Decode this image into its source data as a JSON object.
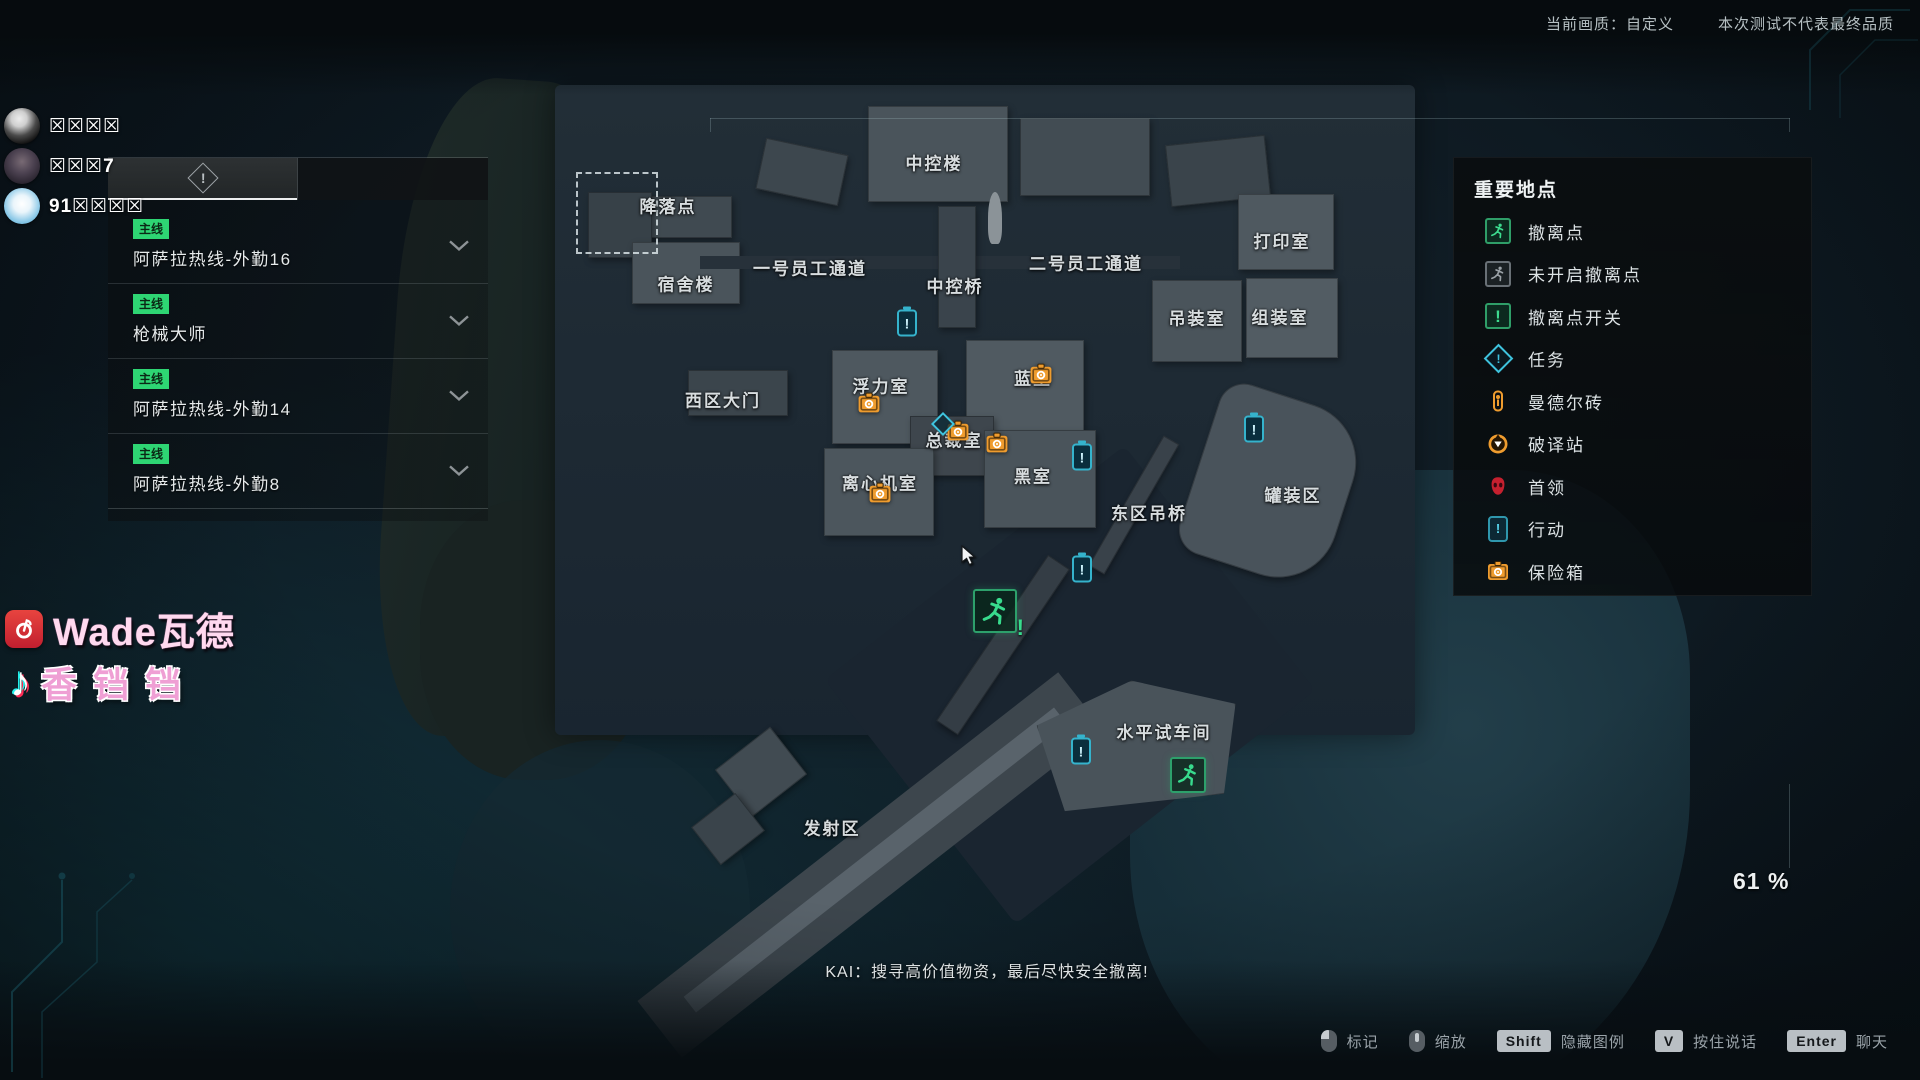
{
  "top_bar": {
    "quality_label": "当前画质：自定义",
    "test_notice": "本次测试不代表最终品质"
  },
  "players": [
    {
      "name": "☒☒☒☒"
    },
    {
      "name": "☒☒☒7"
    },
    {
      "name": "91☒☒☒☒"
    }
  ],
  "quest_panel": {
    "quests": [
      {
        "tag": "主线",
        "title": "阿萨拉热线-外勤16"
      },
      {
        "tag": "主线",
        "title": "枪械大师"
      },
      {
        "tag": "主线",
        "title": "阿萨拉热线-外勤14"
      },
      {
        "tag": "主线",
        "title": "阿萨拉热线-外勤8"
      }
    ]
  },
  "legend": {
    "title": "重要地点",
    "items": [
      {
        "icon": "extraction-active-icon",
        "label": "撤离点"
      },
      {
        "icon": "extraction-inactive-icon",
        "label": "未开启撤离点"
      },
      {
        "icon": "extraction-switch-icon",
        "label": "撤离点开关"
      },
      {
        "icon": "task-icon",
        "label": "任务"
      },
      {
        "icon": "mandel-brick-icon",
        "label": "曼德尔砖"
      },
      {
        "icon": "decoder-icon",
        "label": "破译站"
      },
      {
        "icon": "boss-icon",
        "label": "首领"
      },
      {
        "icon": "operation-icon",
        "label": "行动"
      },
      {
        "icon": "safe-icon",
        "label": "保险箱"
      }
    ]
  },
  "map": {
    "zoom_percent": "61 %",
    "labels": [
      {
        "text": "中控楼",
        "x": 934,
        "y": 162
      },
      {
        "text": "降落点",
        "x": 668,
        "y": 205
      },
      {
        "text": "宿舍楼",
        "x": 686,
        "y": 283
      },
      {
        "text": "一号员工通道",
        "x": 810,
        "y": 267
      },
      {
        "text": "中控桥",
        "x": 955,
        "y": 285
      },
      {
        "text": "二号员工通道",
        "x": 1086,
        "y": 262
      },
      {
        "text": "打印室",
        "x": 1282,
        "y": 240
      },
      {
        "text": "吊装室",
        "x": 1197,
        "y": 317
      },
      {
        "text": "组装室",
        "x": 1280,
        "y": 316
      },
      {
        "text": "西区大门",
        "x": 723,
        "y": 399
      },
      {
        "text": "浮力室",
        "x": 881,
        "y": 385
      },
      {
        "text": "蓝室",
        "x": 1033,
        "y": 377
      },
      {
        "text": "总裁室",
        "x": 954,
        "y": 439
      },
      {
        "text": "黑室",
        "x": 1033,
        "y": 475
      },
      {
        "text": "离心机室",
        "x": 880,
        "y": 482
      },
      {
        "text": "东区吊桥",
        "x": 1149,
        "y": 512
      },
      {
        "text": "罐装区",
        "x": 1293,
        "y": 494
      },
      {
        "text": "水平试车间",
        "x": 1164,
        "y": 731
      },
      {
        "text": "发射区",
        "x": 832,
        "y": 827
      }
    ],
    "markers": [
      {
        "type": "safe",
        "x": 869,
        "y": 403
      },
      {
        "type": "safe",
        "x": 1041,
        "y": 374
      },
      {
        "type": "safe",
        "x": 958,
        "y": 431
      },
      {
        "type": "safe",
        "x": 997,
        "y": 443
      },
      {
        "type": "safe",
        "x": 880,
        "y": 493
      },
      {
        "type": "info",
        "x": 907,
        "y": 323
      },
      {
        "type": "info",
        "x": 1254,
        "y": 429
      },
      {
        "type": "info",
        "x": 1082,
        "y": 457
      },
      {
        "type": "info",
        "x": 1082,
        "y": 569
      },
      {
        "type": "info",
        "x": 1081,
        "y": 751
      },
      {
        "type": "task",
        "x": 943,
        "y": 424
      },
      {
        "type": "exit",
        "x": 995,
        "y": 611,
        "size": 40,
        "excl": true
      },
      {
        "type": "exit",
        "x": 1188,
        "y": 775,
        "size": 32,
        "excl": false
      }
    ]
  },
  "subtitle": "KAI：搜寻高价值物资，最后尽快安全撤离!",
  "watermarks": [
    {
      "platform": "netease-music",
      "name": "Wade瓦德"
    },
    {
      "platform": "tiktok",
      "name": "香铛铛"
    }
  ],
  "hotkeys": [
    {
      "input": "mouse-left",
      "label": "标记"
    },
    {
      "input": "mouse-wheel",
      "label": "缩放"
    },
    {
      "input": "key",
      "key": "Shift",
      "label": "隐藏图例"
    },
    {
      "input": "key",
      "key": "V",
      "label": "按住说话"
    },
    {
      "input": "key",
      "key": "Enter",
      "label": "聊天"
    }
  ]
}
